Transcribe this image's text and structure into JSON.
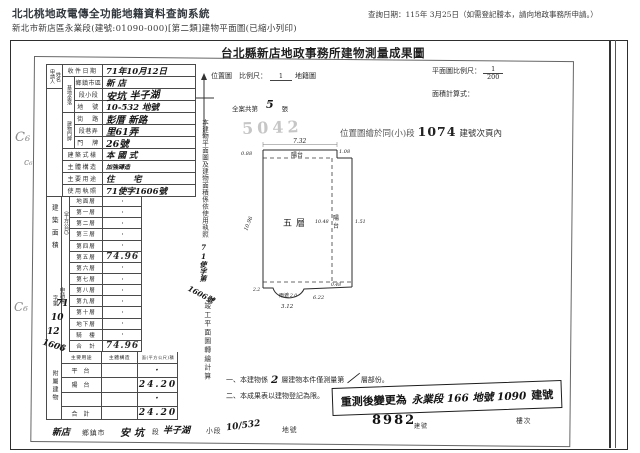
{
  "header": {
    "system_title": "北北桃地政電傳全功能地籍資料查詢系統",
    "subtitle": "新北市新店區永業段(建號:01090-000)[第二類]建物平面圖(已縮小列印)",
    "query_date_note": "查詢日期：115年 3月25日（如需登記謄本，請向地政事務所申請。）"
  },
  "document": {
    "title": "台北縣新店地政事務所建物測量成果圖",
    "location_scale_label": "位置圖　比例尺：",
    "location_scale_num": "1",
    "cadastral_map_label": "地籍圖",
    "plan_scale_label": "平面圖比例尺：",
    "plan_scale_num": "1",
    "plan_scale_den": "200",
    "area_formula_label": "面積計算式：",
    "case_total_prefix": "全案共第",
    "case_total_count": "5",
    "case_total_suffix": "張",
    "faint_stamp": "5042",
    "loc_note_prefix": "位置圖繪於同(小)段",
    "loc_note_number": "1074",
    "loc_note_suffix": "建號次頁內"
  },
  "form": {
    "applicant_label_1": "申請人",
    "applicant_label_2": "姓名",
    "group_base": "基地坐落",
    "group_door": "建物門牌",
    "rows": [
      {
        "label": "收件日期",
        "value": "71年10月12日"
      },
      {
        "label": "鄉鎮市區",
        "value": "新 店"
      },
      {
        "label": "段小段",
        "value": "安坑 半子湖"
      },
      {
        "label": "地　號",
        "value": "10-532 地號"
      },
      {
        "label": "街　路",
        "value": "彭厝 新路"
      },
      {
        "label": "段巷弄",
        "value": "里61弄"
      },
      {
        "label": "門　牌",
        "value": "26號"
      },
      {
        "label": "建築式樣",
        "value": "本 國 式"
      },
      {
        "label": "主體構造",
        "value": "加強磚造"
      },
      {
        "label": "主要用途",
        "value": "住　宅"
      },
      {
        "label": "使用執照",
        "value": "71使字1606號"
      }
    ],
    "area_group_label": "建築面積",
    "unit_label": "（平方公尺）",
    "floors": [
      {
        "label": "地面層",
        "value": "·"
      },
      {
        "label": "第一層",
        "value": "·"
      },
      {
        "label": "第二層",
        "value": "·"
      },
      {
        "label": "第三層",
        "value": "·"
      },
      {
        "label": "第四層",
        "value": "·"
      },
      {
        "label": "第五層",
        "value": "74.96"
      },
      {
        "label": "第六層",
        "value": "·"
      },
      {
        "label": "第七層",
        "value": "·"
      },
      {
        "label": "第八層",
        "value": "·"
      },
      {
        "label": "第九層",
        "value": "·"
      },
      {
        "label": "第十層",
        "value": "·"
      },
      {
        "label": "地下層",
        "value": "·"
      },
      {
        "label": "騎　樓",
        "value": "·"
      },
      {
        "label": "合　計",
        "value": "74.96"
      }
    ],
    "annex": {
      "group_label": "附屬建物",
      "headers": [
        "主要用途",
        "主體構造",
        "面(平方公尺)積"
      ],
      "rows": [
        {
          "use": "平 台",
          "struct": "",
          "area": "·"
        },
        {
          "use": "陽 台",
          "struct": "",
          "area": "24.20"
        },
        {
          "use": "",
          "struct": "",
          "area": "·"
        },
        {
          "use": "合 計",
          "struct": "",
          "area": "24.20"
        }
      ]
    },
    "application": {
      "label": "申請書",
      "word": "字第",
      "num1": "71",
      "num2": "10",
      "num3": "12",
      "num4": "1606",
      "suffix": "號"
    }
  },
  "strips": {
    "clause_part1": "本建物平面圖及建物面積係依使用執照",
    "license_hand": "71使字第",
    "license_hand2": "1606號",
    "clause_part2": "竣工平面圖轉繪計算"
  },
  "plan": {
    "floor_label": "五層",
    "balcony_top": "陽台",
    "balcony_right_1": "陽",
    "balcony_right_2": "台",
    "canopy_label": "雨遮",
    "dims": {
      "top": "7.32",
      "top_left": "0.88",
      "top_right": "1.08",
      "left": "10.96",
      "right_inner": "10.48",
      "right_outer": "1.51",
      "bottom_left": "2.2",
      "canopy_num": "2.0",
      "bottom": "3.12",
      "bottom_mid": "6.22",
      "bottom_dash": "0.48"
    }
  },
  "notes": {
    "n1a": "一、本建物係",
    "n1_hand1": "2",
    "n1b": "層建物本件僅測量第",
    "n1_hand2": "／",
    "n1c": "層部份。",
    "n2": "二、本成果表以建物登記為限。",
    "stamp_prefix": "重測後變更為",
    "stamp_hand": "永業段 166 地號 1090",
    "stamp_suffix": "建號"
  },
  "bottom": {
    "items": [
      {
        "text": "新店"
      },
      {
        "text": "鄉鎮市"
      },
      {
        "text": "安坑"
      },
      {
        "text": "段"
      },
      {
        "text": "半子湖"
      },
      {
        "text": "小段"
      },
      {
        "text": "10/532"
      },
      {
        "text": "地號"
      },
      {
        "text": "8982"
      },
      {
        "text": "建號"
      },
      {
        "text": "樓次"
      }
    ]
  },
  "margin_marks": [
    "C₆",
    "c₆",
    "C₆"
  ]
}
